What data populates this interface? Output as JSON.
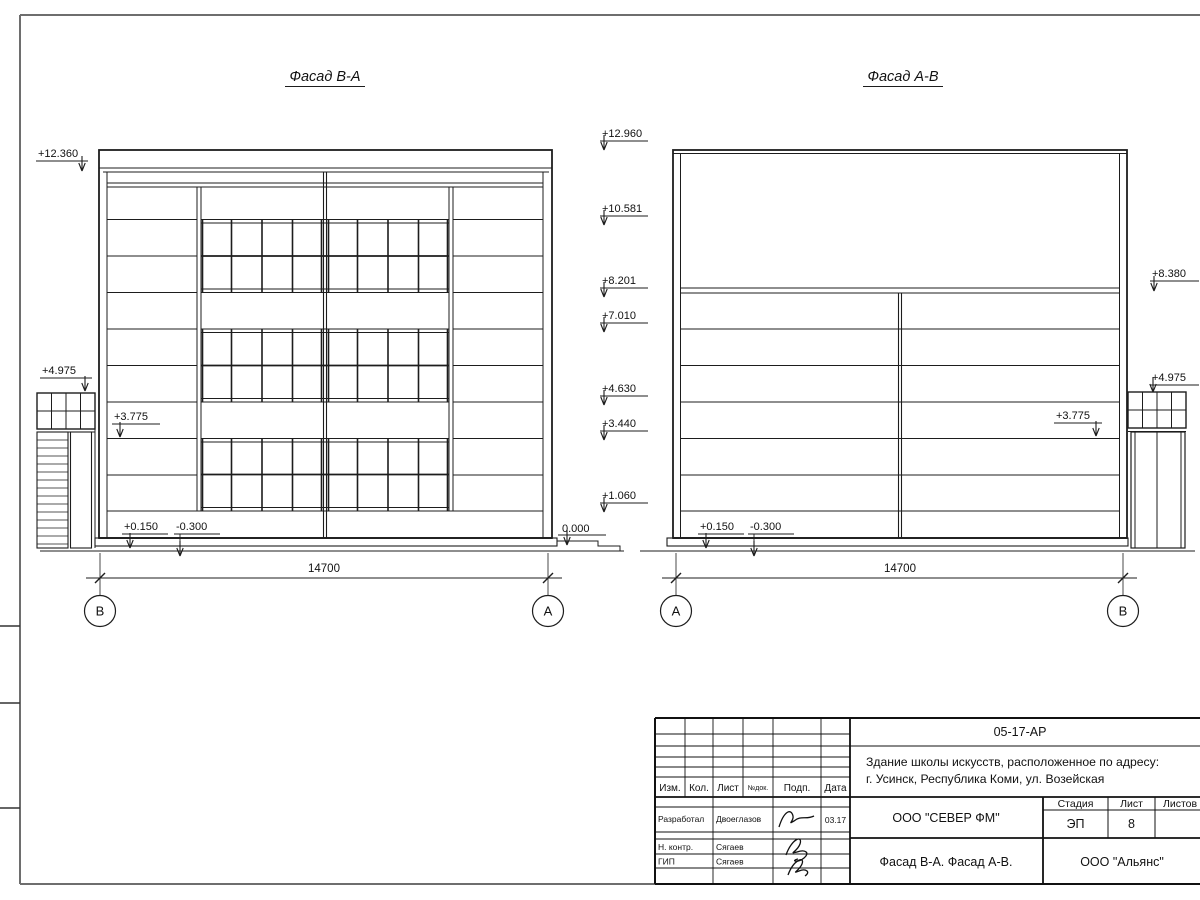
{
  "titles": {
    "left": "Фасад В-А",
    "right": "Фасад А-В"
  },
  "elevations": {
    "left": {
      "roof": "+12.360",
      "tower": "+4.975",
      "floor2": "+3.775",
      "plinth": "+0.150",
      "ground": "-0.300",
      "zero": "0.000"
    },
    "center": [
      "+12.960",
      "+10.581",
      "+8.201",
      "+7.010",
      "+4.630",
      "+3.440",
      "+1.060"
    ],
    "right": {
      "hall": "+8.380",
      "tower": "+4.975",
      "floor2": "+3.775",
      "plinth": "+0.150",
      "ground": "-0.300"
    }
  },
  "dimensions": {
    "left_width": "14700",
    "right_width": "14700"
  },
  "axes": {
    "left_start": "В",
    "left_end": "А",
    "right_start": "А",
    "right_end": "В"
  },
  "stamp": {
    "doc_code": "05-17-АР",
    "project_line1": "Здание школы искусств, расположенное по адресу:",
    "project_line2": "г. Усинск, Республика Коми, ул. Возейская",
    "col_izm": "Изм.",
    "col_kol": "Кол.",
    "col_list": "Лист",
    "col_doc": "№док.",
    "col_podp": "Подп.",
    "col_data": "Дата",
    "row1_role": "Разработал",
    "row1_name": "Двоеглазов",
    "row1_date": "03.17",
    "row2_role": "Н. контр.",
    "row2_name": "Сягаев",
    "row3_role": "ГИП",
    "row3_name": "Сягаев",
    "org": "ООО \"СЕВЕР ФМ\"",
    "stage_label": "Стадия",
    "sheet_label": "Лист",
    "sheets_label": "Листов",
    "stage_value": "ЭП",
    "sheet_value": "8",
    "drawing_title": "Фасад В-А. Фасад А-В.",
    "org2": "ООО \"Альянс\""
  }
}
